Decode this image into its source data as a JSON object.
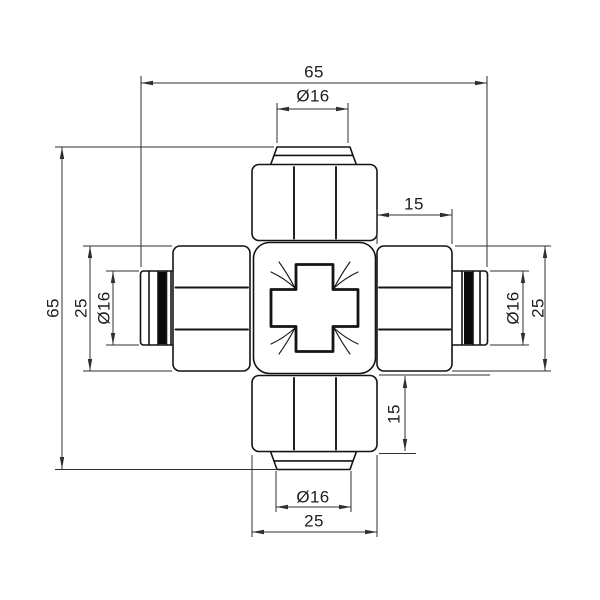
{
  "page": {
    "type": "technical-drawing",
    "subject": "4-way cross compression pipe fitting, orthographic front view with dimensions",
    "background": "#ffffff"
  },
  "colors": {
    "bg": "#ffffff",
    "line": "#141414",
    "dim": "#2f2f2f",
    "text": "#1d1d1d",
    "seal": "#0a0a0a"
  },
  "dim_labels": {
    "top_overall_width": "65",
    "top_port_diameter": "Ø16",
    "right_hex_length": "15",
    "left_overall_height": "65",
    "left_hex_width": "25",
    "left_port_diameter": "Ø16",
    "right_port_diameter": "Ø16",
    "right_hex_width": "25",
    "bottom_hex_length": "15",
    "bottom_port_diameter": "Ø16",
    "bottom_hex_width": "25"
  }
}
